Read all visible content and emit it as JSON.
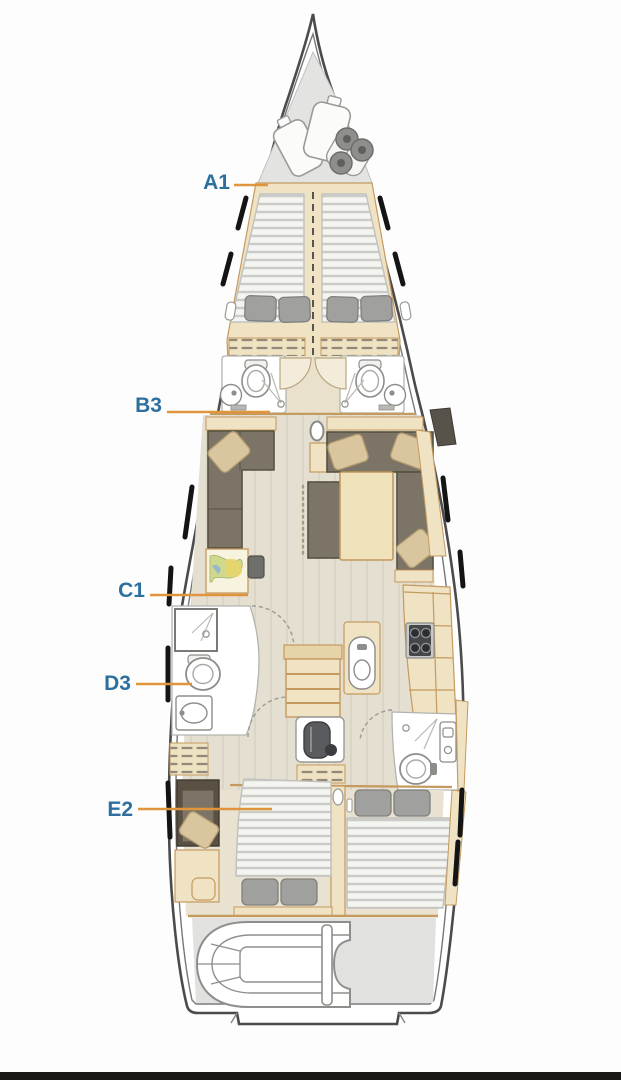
{
  "diagram": {
    "type": "yacht-interior-layout-plan",
    "labels": [
      {
        "text": "A1",
        "area": "forward-owner-cabin"
      },
      {
        "text": "B3",
        "area": "forward-heads"
      },
      {
        "text": "C1",
        "area": "salon"
      },
      {
        "text": "D3",
        "area": "midship-head"
      },
      {
        "text": "E2",
        "area": "aft-cabins"
      }
    ],
    "colors": {
      "label_text": "#2d6f9e",
      "leader_line": "#e0953c",
      "hull_outline": "#4b4b4d",
      "hull_inner_line": "#77777a",
      "wood_light": "#efe3c4",
      "wood_trim": "#c49a5f",
      "floor_beige": "#e5dfd1",
      "cushion_dark": "#7c7466",
      "pillow_gray": "#9e9e9c",
      "pillow_beige": "#d9c59e",
      "locker_gray": "#e3e3e1",
      "garage_gray": "#e1e1df",
      "stove_dark": "#45464a",
      "bottom_bar": "#1a1714"
    }
  }
}
